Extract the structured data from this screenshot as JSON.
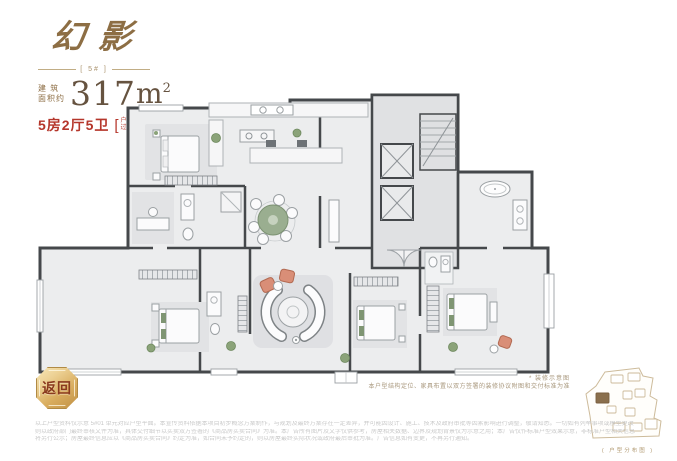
{
  "header": {
    "title": "幻影",
    "unit_label": "[ 5# ]",
    "area_label_top": "建 筑",
    "area_label_bottom": "面积约",
    "area_value": "317",
    "area_unit": "m",
    "area_sup": "2",
    "rooms": "5房2厅5卫",
    "note_bracket_left": "[",
    "note_bracket_right": "]",
    "note_line1": "户型方案",
    "note_line2": "过 程 稿"
  },
  "back_button": {
    "label": "返回"
  },
  "decor_note": {
    "title": "* 装修示意图",
    "body": "本户型结构定位、家具布置以双方签署的装修协议附图和交付标准为准"
  },
  "site_map": {
    "caption": "( 户型分布图 )"
  },
  "disclaimer": {
    "line1": "以上户型资料仅示意 5#01 单元对应户型平面。本宣传资料依据本项目初步概念方案制作，与规划及最终方案存在一定差异，并可能因设计、施工、技术及政府审批等因素影响进行调整，敬请知悉。一切如有列举事项或模型更改",
    "line2": "则以政府部门最终审核文件为准，具体交付细节以买卖双方签署的《商品房买卖合同》为准。本广告所有图片及文字仅供参考，房屋相关数据、边界及规划背景仅为示意之用；本广告仅作标准户型效果示意，非标准户型相关信息",
    "line3": "将另行公示；房屋最终信息应以《商品房买卖合同》约定为准，如合同未予约定的，则以房屋最终实际状况或政府最后审批为准。广告信息如有变更，不再另行通知。"
  },
  "colors": {
    "brand_gold": "#8d6e44",
    "area_brown": "#665340",
    "accent_red": "#b5362b",
    "badge_gold_light": "#f8e8ba",
    "badge_gold_dark": "#bf8f43",
    "badge_text": "#8a3a1e",
    "note_gold": "#a8977c",
    "map_line_gold": "#cdbb9b",
    "map_highlight": "#8a6f4d",
    "wall": "#45484b",
    "floor": "#ecedee",
    "rug": "#dfe0e3",
    "dining_table_green": "#9aae90",
    "plant_green": "#8ba379",
    "coral_chair": "#d98e77",
    "disclaimer_gray": "#c9c9c9"
  }
}
